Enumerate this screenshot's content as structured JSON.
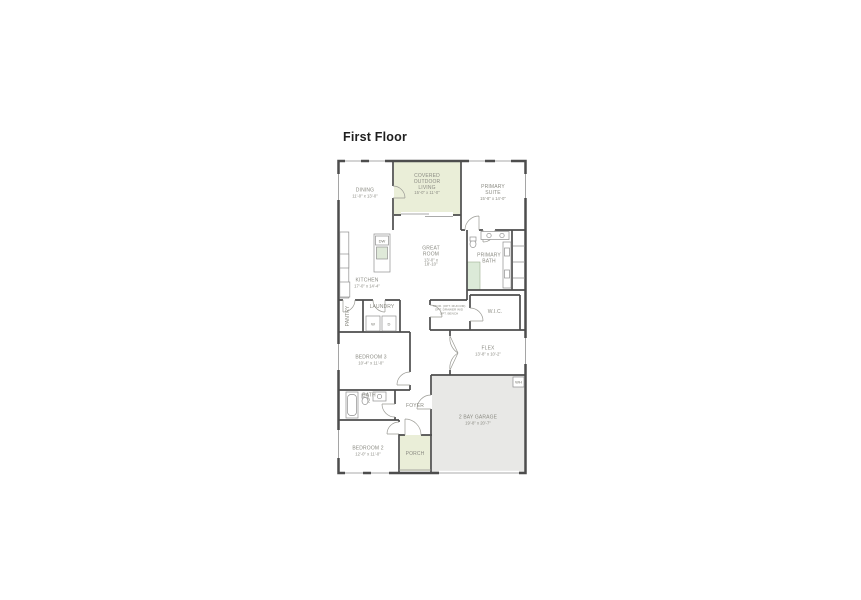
{
  "page": {
    "title": "First Floor"
  },
  "plan": {
    "rooms": {
      "dining": {
        "name": "DINING",
        "dims": "11'-0\" x 13'-0\""
      },
      "covered_outdoor_living": {
        "name": "COVERED OUTDOOR LIVING",
        "dims": "15'-0\" x 11'-0\""
      },
      "primary_suite": {
        "name": "PRIMARY SUITE",
        "dims": "15'-8\" x 14'-0\""
      },
      "great_room": {
        "name": "GREAT ROOM",
        "dims": "13'-0\" x 18'-10\""
      },
      "kitchen": {
        "name": "KITCHEN",
        "dims": "17'-0\" x 14'-4\""
      },
      "primary_bath": {
        "name": "PRIMARY BATH"
      },
      "wic": {
        "name": "W.I.C."
      },
      "laundry": {
        "name": "LAUNDRY"
      },
      "pantry": {
        "name": "PANTRY"
      },
      "bedroom_3": {
        "name": "BEDROOM 3",
        "dims": "10'-4\" x 11'-0\""
      },
      "flex": {
        "name": "FLEX",
        "dims": "13'-8\" x 10'-2\""
      },
      "bath_2": {
        "name": "BATH 2"
      },
      "foyer": {
        "name": "FOYER"
      },
      "garage": {
        "name": "2 BAY GARAGE",
        "dims": "19'-8\" x 20'-7\""
      },
      "bedroom_2": {
        "name": "BEDROOM 2",
        "dims": "12'-0\" x 11'-0\""
      },
      "porch": {
        "name": "PORCH"
      }
    },
    "notes": {
      "storage_option": "STOR. (OPT. MUD RM) OPT. DRAWER W/D OPT. BENCH"
    },
    "fixtures": {
      "dishwasher": "DW",
      "washer": "W",
      "dryer": "D",
      "water_heater": "WH"
    },
    "colors": {
      "wall": "#4d4d4d",
      "outdoor_fill": "#eaeed8",
      "garage_fill": "#e8e8e6",
      "shower_fill": "#dcead8",
      "label_text": "#8b8b83"
    }
  }
}
